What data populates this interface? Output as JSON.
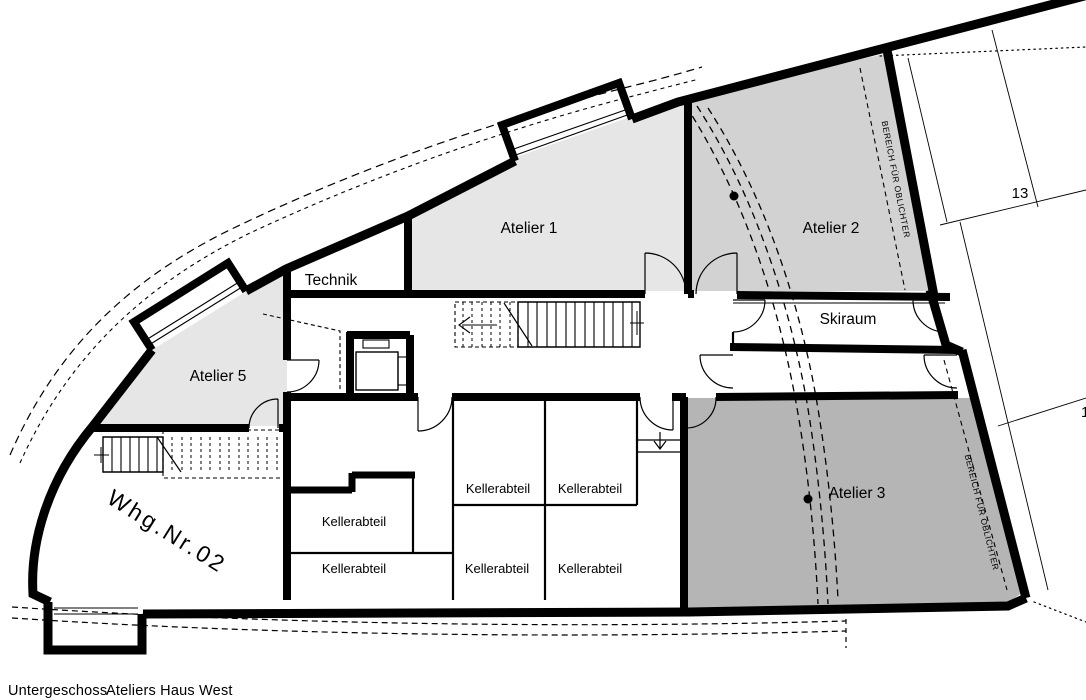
{
  "plan": {
    "rooms": {
      "atelier1": "Atelier 1",
      "atelier2": "Atelier 2",
      "atelier3": "Atelier 3",
      "atelier5": "Atelier 5",
      "technik": "Technik",
      "skiraum": "Skiraum",
      "whg": "Whg.Nr.02",
      "kellerabteil": "Kellerabteil"
    },
    "annotations": {
      "oblichter": "BEREICH FÜR OBLICHTER",
      "parcel13": "13",
      "parcelPartial": "1"
    },
    "caption": {
      "floor": "Untergeschoss",
      "building": "Ateliers Haus West"
    },
    "colors": {
      "wall": "#000000",
      "atelierLight": "#e6e6e6",
      "atelierMid": "#d2d2d2",
      "atelierDark": "#b5b5b5",
      "background": "#ffffff"
    }
  }
}
